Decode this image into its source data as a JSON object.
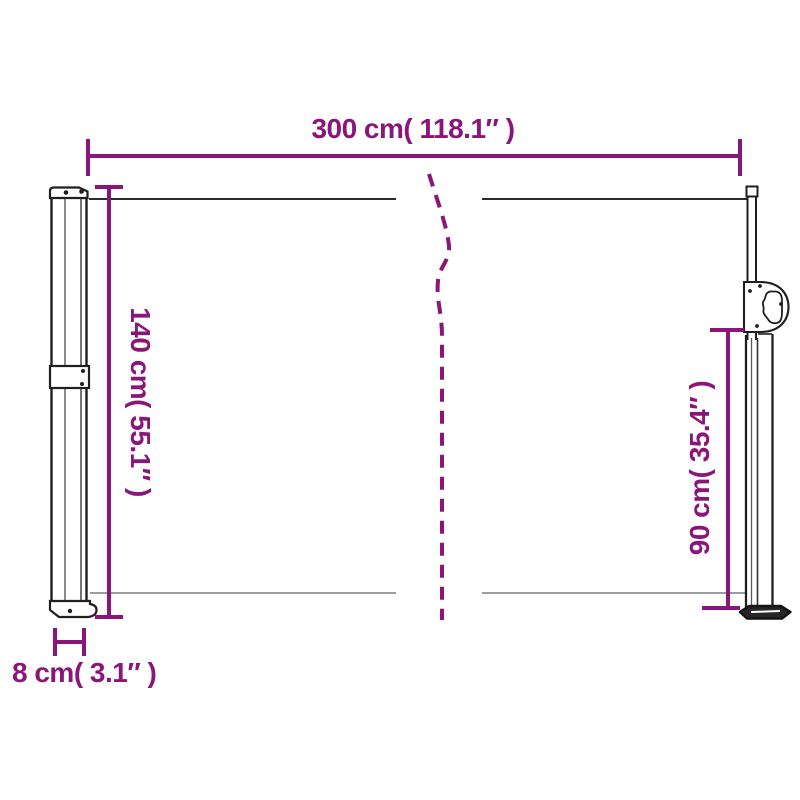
{
  "diagram": {
    "kind": "product-dimension-diagram",
    "colors": {
      "dimension": "#8A1679",
      "outline": "#1f1f1f",
      "outline_soft": "#5a5a5a",
      "edge": "#7a7a7a",
      "background": "#ffffff"
    },
    "dimensions": {
      "width": {
        "label": "300 cm( 118.1″ )",
        "cm": 300,
        "inch": 118.1
      },
      "height_left": {
        "label": "140 cm( 55.1″ )",
        "cm": 140,
        "inch": 55.1
      },
      "height_right": {
        "label": "90 cm( 35.4″ )",
        "cm": 90,
        "inch": 35.4
      },
      "depth": {
        "label": "8 cm( 3.1″ )",
        "cm": 8,
        "inch": 3.1
      }
    }
  }
}
